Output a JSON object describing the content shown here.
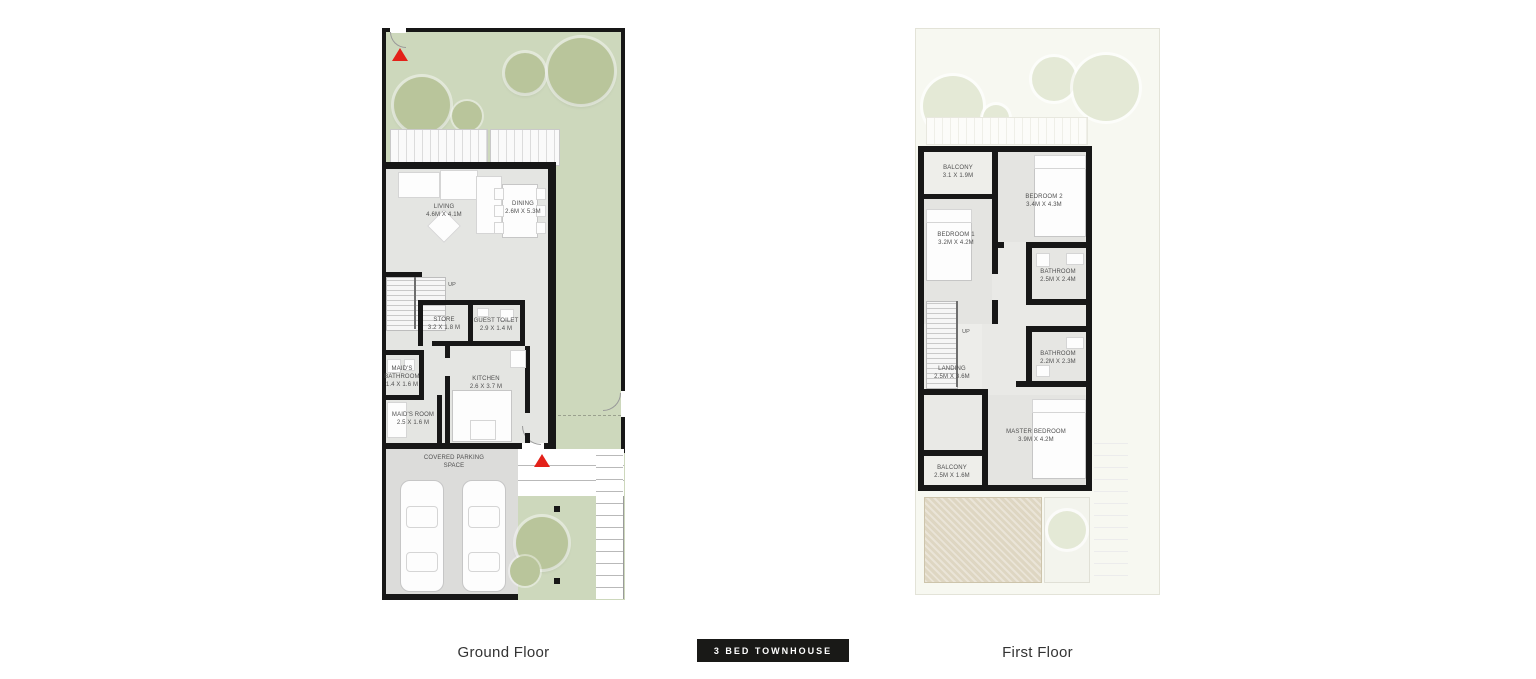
{
  "badge": {
    "label": "3 BED TOWNHOUSE",
    "bg": "#191917"
  },
  "ground_floor": {
    "caption": "Ground Floor",
    "up": "UP",
    "living": {
      "name": "LIVING",
      "dims": "4.6M X 4.1M"
    },
    "dining": {
      "name": "DINING",
      "dims": "2.6M X 5.3M"
    },
    "store": {
      "name": "STORE",
      "dims": "3.2 X 1.8 M"
    },
    "guest_toilet": {
      "name": "GUEST TOILET",
      "dims": "2.9 X 1.4 M"
    },
    "maids_bathroom": {
      "name": "MAID'S BATHROOM",
      "dims": "1.4 X 1.6 M"
    },
    "kitchen": {
      "name": "KITCHEN",
      "dims": "2.6 X 3.7 M"
    },
    "maids_room": {
      "name": "MAID'S ROOM",
      "dims": "2.5 X 1.6 M"
    },
    "parking": {
      "name": "COVERED PARKING SPACE"
    }
  },
  "first_floor": {
    "caption": "First Floor",
    "up": "UP",
    "balcony_top": {
      "name": "BALCONY",
      "dims": "3.1 X 1.9M"
    },
    "bedroom2": {
      "name": "BEDROOM 2",
      "dims": "3.4M X 4.3M"
    },
    "bedroom1": {
      "name": "BEDROOM 1",
      "dims": "3.2M X 4.2M"
    },
    "bathroom1": {
      "name": "BATHROOM",
      "dims": "2.5M X 2.4M"
    },
    "landing": {
      "name": "LANDING",
      "dims": "2.5M X 3.6M"
    },
    "bathroom2": {
      "name": "BATHROOM",
      "dims": "2.2M X 2.3M"
    },
    "master_bedroom": {
      "name": "MASTER BEDROOM",
      "dims": "3.9M X 4.2M"
    },
    "balcony_bottom": {
      "name": "BALCONY",
      "dims": "2.5M X 1.6M"
    }
  },
  "colors": {
    "garden_green": "#cdd8bc",
    "tree_green": "#b9c59b",
    "wall_black": "#171717",
    "interior_gray": "#e4e5e2",
    "parking_gray": "#dcdcda",
    "roof_beige": "#ded6c2",
    "marker_red": "#e32119",
    "badge_black": "#191917",
    "faded_plot": "#f7f8f1"
  }
}
